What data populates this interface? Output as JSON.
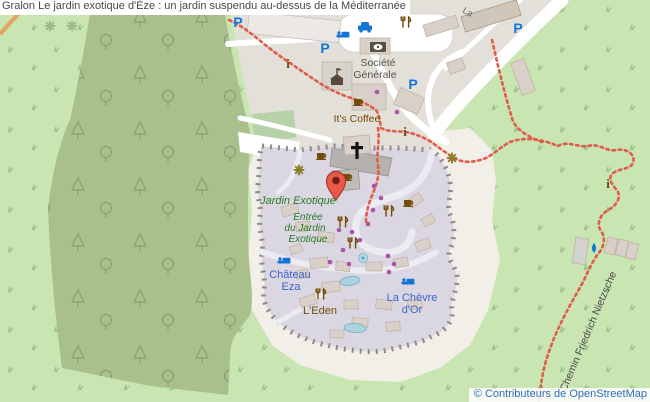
{
  "header": {
    "title": "Gralon Le jardin exotique d'Èze : un jardin suspendu au-dessus de la Méditerranée"
  },
  "map": {
    "attribution": "© Contributeurs de OpenStreetMap",
    "labels": {
      "garden": "Jardin Exotique",
      "entrance_l1": "Entrée",
      "entrance_l2": "du Jardin",
      "entrance_l3": "Exotique",
      "chateau_l1": "Château",
      "chateau_l2": "Eza",
      "eden": "L'Eden",
      "chevre_l1": "La Chèvre",
      "chevre_l2": "d'Or",
      "bank_l1": "Société",
      "bank_l2": "Générale",
      "coffee": "It's Coffee",
      "path": "Chemin Friedrich Nietzsche",
      "road_fragment": "La",
      "parking": "P",
      "information": "i"
    },
    "icons": {
      "marker-pin-icon": "red location pin",
      "parking-icon": "blue letter P",
      "hotel-icon": "blue bed",
      "taxi-icon": "blue car",
      "bank-icon": "dark building with coin",
      "townhall-icon": "brown building with flag",
      "information-icon": "brown serif i",
      "restaurant-icon": "brown fork and knife",
      "cafe-icon": "brown coffee cup",
      "church-cross-icon": "black cross",
      "attraction-icon": "olive eight-petal flower",
      "drinking-water-icon": "blue droplet",
      "fountain-icon": "blue circle",
      "shop-dot-icon": "purple dot",
      "trail-icon": "red dotted hiking path"
    },
    "colors": {
      "grass": "#c8e5b2",
      "forest": "#a9c08d",
      "urban": "#e3e0da",
      "village": "#dad7e2",
      "cliff_sand": "#f2efe9",
      "building": "#d9d0c9",
      "road": "#ffffff",
      "trail": "#e05c4b",
      "shop_dot": "#a855a8",
      "poi_blue": "#1375d8",
      "poi_brown": "#734a08",
      "label_green": "#267a26",
      "label_blue": "#3f63cc",
      "label_gray": "#55524b",
      "marker": "#ea5848",
      "attribution_blue": "#2f6bbf",
      "title_text": "#484848"
    }
  }
}
